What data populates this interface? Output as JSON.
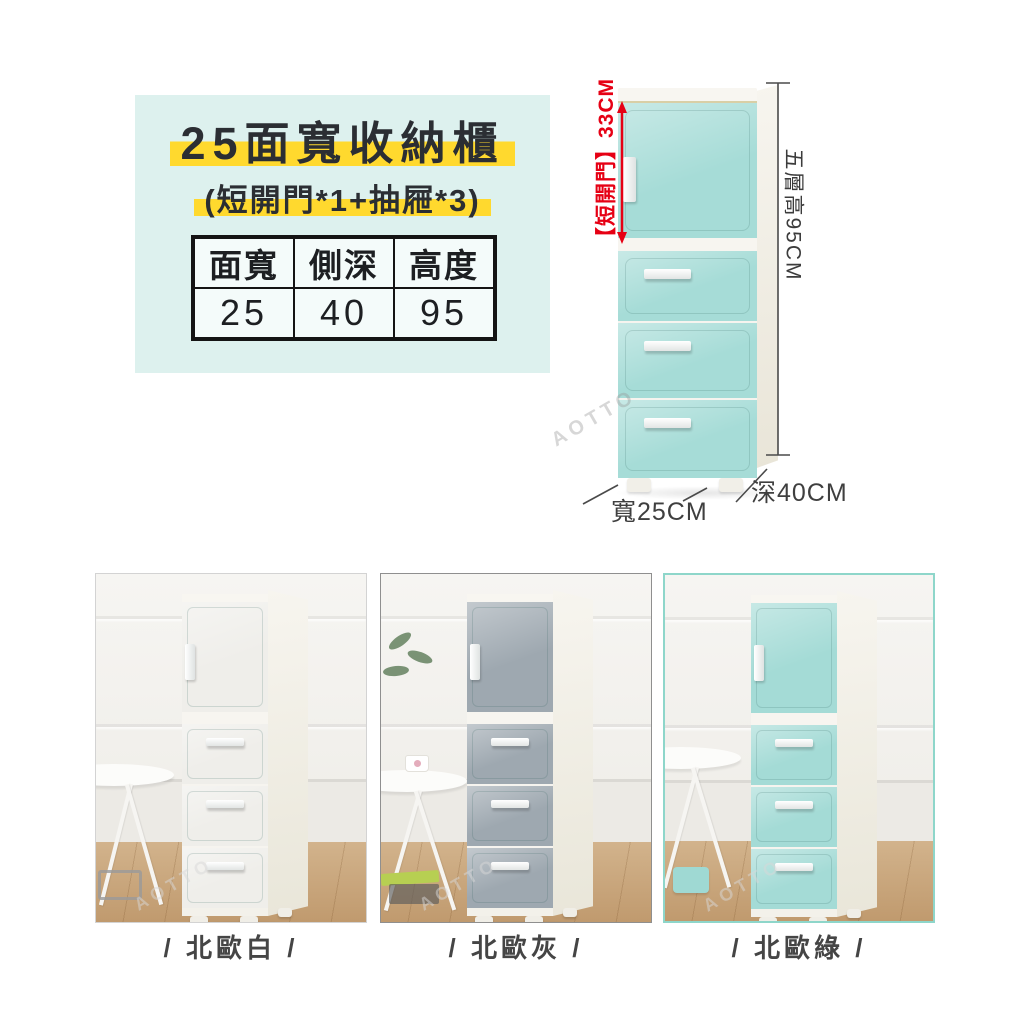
{
  "info_card": {
    "title": "25面寬收納櫃",
    "subtitle": "(短開門*1+抽屜*3)",
    "highlight_color": "#ffd92e",
    "background_color": "#ddf1ee",
    "spec_table": {
      "headers": [
        "面寬",
        "側深",
        "高度"
      ],
      "values": [
        "25",
        "40",
        "95"
      ]
    }
  },
  "diagram": {
    "door_height_label": "【短開門】33CM",
    "total_height_label": "五層高95CM",
    "width_label": "寬25CM",
    "depth_label": "深40CM",
    "annotation_color": "#e60014",
    "cabinet_color": "#a6dcd7",
    "watermark": "AOTTO"
  },
  "variants": [
    {
      "label": "/ 北歐白 /",
      "panel_color": "#efeeea",
      "border_color": "#d3d3d3"
    },
    {
      "label": "/ 北歐灰 /",
      "panel_color": "#9ea8b0",
      "border_color": "#8f8f8f"
    },
    {
      "label": "/ 北歐綠 /",
      "panel_color": "#a4dbd6",
      "border_color": "#8ed6ca"
    }
  ]
}
